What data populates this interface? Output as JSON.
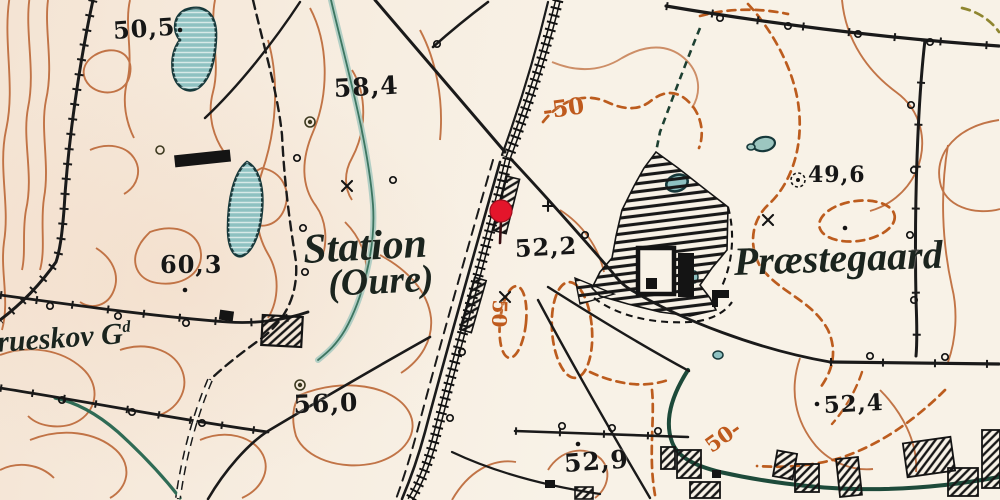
{
  "map": {
    "title": "Historical topographic map — Oure Station area",
    "labels": {
      "s505": {
        "text": "50,5",
        "kind": "elevation"
      },
      "s584": {
        "text": "58,4",
        "kind": "elevation"
      },
      "n50top": {
        "text": "-50",
        "kind": "contour-value"
      },
      "s603": {
        "text": "60,3",
        "kind": "elevation"
      },
      "station": {
        "text": "Station",
        "kind": "place-name"
      },
      "oure": {
        "text": "(Oure)",
        "kind": "place-name"
      },
      "s522": {
        "text": "52,2",
        "kind": "elevation"
      },
      "s496": {
        "text": "49,6",
        "kind": "elevation"
      },
      "praestegaard": {
        "text": "Præstegaard",
        "kind": "place-name"
      },
      "grueskov": {
        "text": "rueskov G",
        "kind": "place-name"
      },
      "grueskov_sup": {
        "text": "d",
        "kind": "place-name-suffix"
      },
      "s560": {
        "text": "56,0",
        "kind": "elevation"
      },
      "s529": {
        "text": "52,9",
        "kind": "elevation"
      },
      "s524": {
        "text": "52,4",
        "kind": "elevation"
      },
      "n50bottom": {
        "text": "50-",
        "kind": "contour-value"
      },
      "n50mid": {
        "text": "50",
        "kind": "contour-value"
      }
    },
    "marker": {
      "name": "red-map-pin",
      "x": 501,
      "y": 211,
      "color": "#e4152b"
    },
    "colors": {
      "background": "#f8f2e7",
      "ink": "#1a1a1a",
      "contour": "#bd6a3a",
      "contour_dashed": "#bc5c1e",
      "water_fill": "#8ec1c1",
      "water_outline": "#16383a",
      "stream": "#1d4a3a",
      "pale_stream": "#a6c9c0",
      "pin": "#e4152b"
    }
  }
}
